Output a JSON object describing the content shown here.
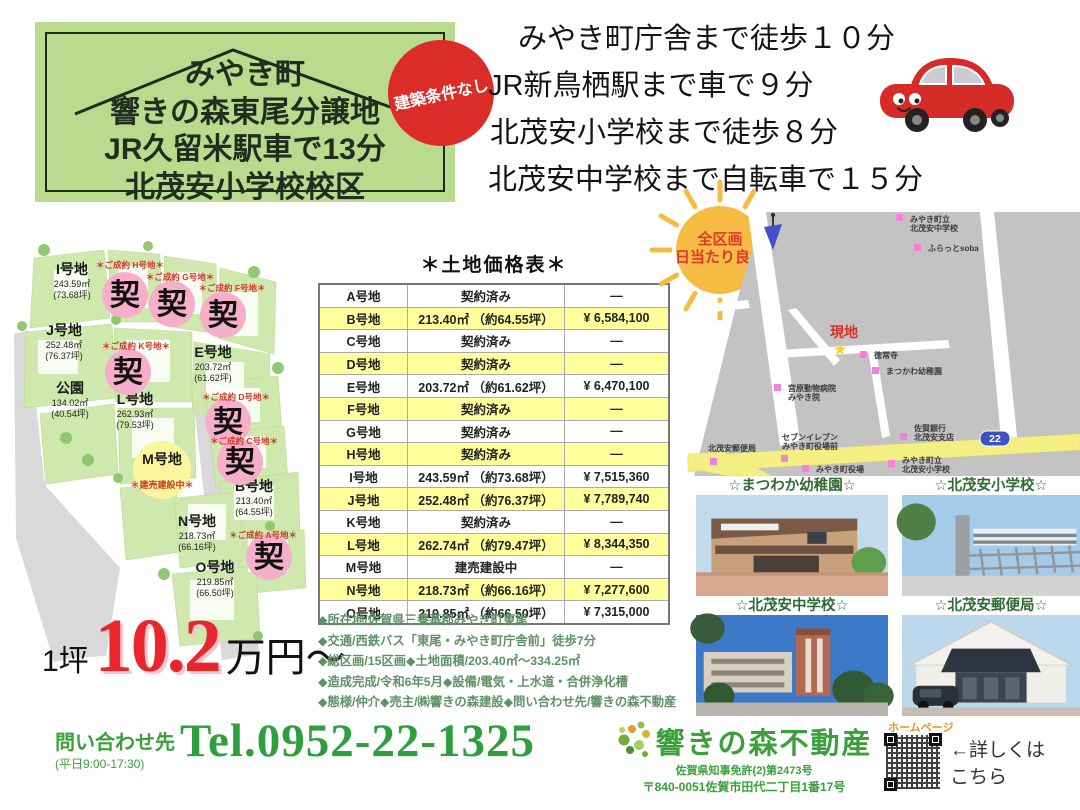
{
  "header": {
    "box_lines": [
      {
        "text": "みやき町"
      },
      {
        "text": "響きの森東尾分譲地"
      },
      {
        "text": "JR久留米駅車で13分"
      },
      {
        "text": "北茂安小学校校区"
      }
    ],
    "badge": "建築条件なし",
    "access_lines": [
      {
        "text": "みやき町庁舎まで徒歩１０分"
      },
      {
        "text": "JR新鳥栖駅まで車で９分"
      },
      {
        "text": "北茂安小学校まで徒歩８分"
      },
      {
        "text": "北茂安中学校まで自転車で１５分"
      }
    ]
  },
  "site_plan": {
    "sold_mark": "契",
    "plots": [
      {
        "name": "I号地",
        "area": "243.59㎡",
        "tsubo": "(73.68坪)",
        "x": 64,
        "y": 36
      },
      {
        "name": "J号地",
        "area": "252.48㎡",
        "tsubo": "(76.37坪)",
        "x": 56,
        "y": 97
      },
      {
        "name": "公園",
        "area": "134.02㎡",
        "tsubo": "(40.54坪)",
        "x": 62,
        "y": 155
      },
      {
        "name": "E号地",
        "area": "203.72㎡",
        "tsubo": "(61.62坪)",
        "x": 205,
        "y": 119
      },
      {
        "name": "L号地",
        "area": "262.93㎡",
        "tsubo": "(79.53坪)",
        "x": 127,
        "y": 166
      },
      {
        "name": "M号地",
        "tsubo": "＊建売建設中＊",
        "x": 154,
        "y": 226,
        "mark": "yellow"
      },
      {
        "name": "B号地",
        "area": "213.40㎡",
        "tsubo": "(64.55坪)",
        "x": 246,
        "y": 253
      },
      {
        "name": "N号地",
        "area": "218.73㎡",
        "tsubo": "(66.16坪)",
        "x": 189,
        "y": 288
      },
      {
        "name": "O号地",
        "area": "219.85㎡",
        "tsubo": "(66.50坪)",
        "x": 207,
        "y": 334
      }
    ],
    "sold": [
      {
        "note": "＊ご成約 H号地＊",
        "nx": 122,
        "ny": 30,
        "cx": 117,
        "cy": 57
      },
      {
        "note": "＊ご成約 G号地＊",
        "nx": 172,
        "ny": 42,
        "cx": 164,
        "cy": 66
      },
      {
        "note": "＊ご成約 F号地＊",
        "nx": 224,
        "ny": 53,
        "cx": 215,
        "cy": 77
      },
      {
        "note": "＊ご成約 K号地＊",
        "nx": 128,
        "ny": 111,
        "cx": 120,
        "cy": 134
      },
      {
        "note": "＊ご成約 D号地＊",
        "nx": 228,
        "ny": 162,
        "cx": 220,
        "cy": 184
      },
      {
        "note": "＊ご成約 C号地＊",
        "nx": 236,
        "ny": 206,
        "cx": 232,
        "cy": 224
      },
      {
        "note": "＊ご成約 A号地＊",
        "nx": 255,
        "ny": 300,
        "cx": 261,
        "cy": 319
      }
    ]
  },
  "price": {
    "prefix": "1坪",
    "value": "10.2",
    "suffix": "万円〜"
  },
  "price_table": {
    "title": "＊土地価格表＊",
    "rows": [
      {
        "plot": "A号地",
        "detail": "契約済み",
        "price": "—",
        "hl": false
      },
      {
        "plot": "B号地",
        "detail": "213.40㎡ （約64.55坪）",
        "price": "¥ 6,584,100",
        "hl": true
      },
      {
        "plot": "C号地",
        "detail": "契約済み",
        "price": "—",
        "hl": false
      },
      {
        "plot": "D号地",
        "detail": "契約済み",
        "price": "—",
        "hl": true
      },
      {
        "plot": "E号地",
        "detail": "203.72㎡ （約61.62坪）",
        "price": "¥ 6,470,100",
        "hl": false
      },
      {
        "plot": "F号地",
        "detail": "契約済み",
        "price": "—",
        "hl": true
      },
      {
        "plot": "G号地",
        "detail": "契約済み",
        "price": "—",
        "hl": false
      },
      {
        "plot": "H号地",
        "detail": "契約済み",
        "price": "—",
        "hl": true
      },
      {
        "plot": "I号地",
        "detail": "243.59㎡ （約73.68坪）",
        "price": "¥ 7,515,360",
        "hl": false
      },
      {
        "plot": "J号地",
        "detail": "252.48㎡ （約76.37坪）",
        "price": "¥ 7,789,740",
        "hl": true
      },
      {
        "plot": "K号地",
        "detail": "契約済み",
        "price": "—",
        "hl": false
      },
      {
        "plot": "L号地",
        "detail": "262.74㎡ （約79.47坪）",
        "price": "¥ 8,344,350",
        "hl": true
      },
      {
        "plot": "M号地",
        "detail": "建売建設中",
        "price": "—",
        "hl": false
      },
      {
        "plot": "N号地",
        "detail": "218.73㎡ （約66.16坪）",
        "price": "¥ 7,277,600",
        "hl": true
      },
      {
        "plot": "O号地",
        "detail": "219.85㎡ （約66.50坪）",
        "price": "¥ 7,315,000",
        "hl": false
      }
    ]
  },
  "details": {
    "lines": [
      {
        "text": "◆所在地/佐賀県三養基郡みやき町東尾"
      },
      {
        "text": "◆交通/西鉄バス「東尾・みやき町庁舎前」徒歩7分"
      },
      {
        "text": "◆総区画/15区画◆土地面積/203.40㎡〜334.25㎡"
      },
      {
        "text": "◆造成完成/令和6年5月◆設備/電気・上水道・合併浄化槽"
      },
      {
        "text": "◆態様/仲介◆売主/㈱響きの森建設◆問い合わせ先/響きの森不動産"
      }
    ]
  },
  "map": {
    "sun_line1": "全区画",
    "sun_line2": "日当たり良好",
    "genchi": "現地",
    "star": "★",
    "route_number": "22",
    "labels": [
      {
        "lines": [
          "みやき町立",
          "北茂安中学校"
        ],
        "x": 222,
        "y": 12,
        "dot": [
          208,
          4
        ]
      },
      {
        "lines": [
          "ふらっとsoba"
        ],
        "x": 240,
        "y": 41,
        "dot": [
          226,
          34
        ]
      },
      {
        "lines": [
          "徳常寺"
        ],
        "x": 186,
        "y": 148,
        "dot": [
          172,
          141
        ]
      },
      {
        "lines": [
          "まつかわ幼稚園"
        ],
        "x": 198,
        "y": 164,
        "dot": [
          184,
          157
        ]
      },
      {
        "lines": [
          "宮原動物病院",
          "みやき院"
        ],
        "x": 100,
        "y": 181,
        "dot": [
          86,
          174
        ]
      },
      {
        "lines": [
          "佐賀銀行",
          "北茂安支店"
        ],
        "x": 226,
        "y": 221,
        "dot": [
          212,
          223
        ]
      },
      {
        "lines": [
          "セブンイレブン",
          "みやき町役場前"
        ],
        "x": 94,
        "y": 230,
        "dot": [
          93,
          245
        ]
      },
      {
        "lines": [
          "北茂安郵便局"
        ],
        "x": 20,
        "y": 241,
        "dot": [
          22,
          248
        ]
      },
      {
        "lines": [
          "みやき町役場"
        ],
        "x": 128,
        "y": 262,
        "dot": [
          114,
          255
        ]
      },
      {
        "lines": [
          "みやき町立",
          "北茂安小学校"
        ],
        "x": 214,
        "y": 253,
        "dot": [
          200,
          250
        ]
      }
    ]
  },
  "photos": [
    {
      "caption": "☆まつわか幼稚園☆"
    },
    {
      "caption": "☆北茂安小学校☆"
    },
    {
      "caption": "☆北茂安中学校☆"
    },
    {
      "caption": "☆北茂安郵便局☆"
    }
  ],
  "contact": {
    "inquiry": "問い合わせ先",
    "hours": "(平日9:00-17:30)",
    "tel": "Tel.0952-22-1325",
    "company": "響きの森不動産",
    "license": "佐賀県知事免許(2)第2473号",
    "address": "〒840-0051佐賀市田代二丁目1番17号",
    "homepage": "ホームページ",
    "qr_note_line1": "←詳しくは",
    "qr_note_line2": "こちら"
  },
  "colors": {
    "brand_green": "#3aa13a",
    "price_red": "#e8262b",
    "badge_red": "#dc2c28",
    "title_box_green": "#b9db8e",
    "table_highlight": "#ffff9c",
    "sold_pink": "#f6aecb",
    "map_poi_pink": "#f083d6"
  }
}
